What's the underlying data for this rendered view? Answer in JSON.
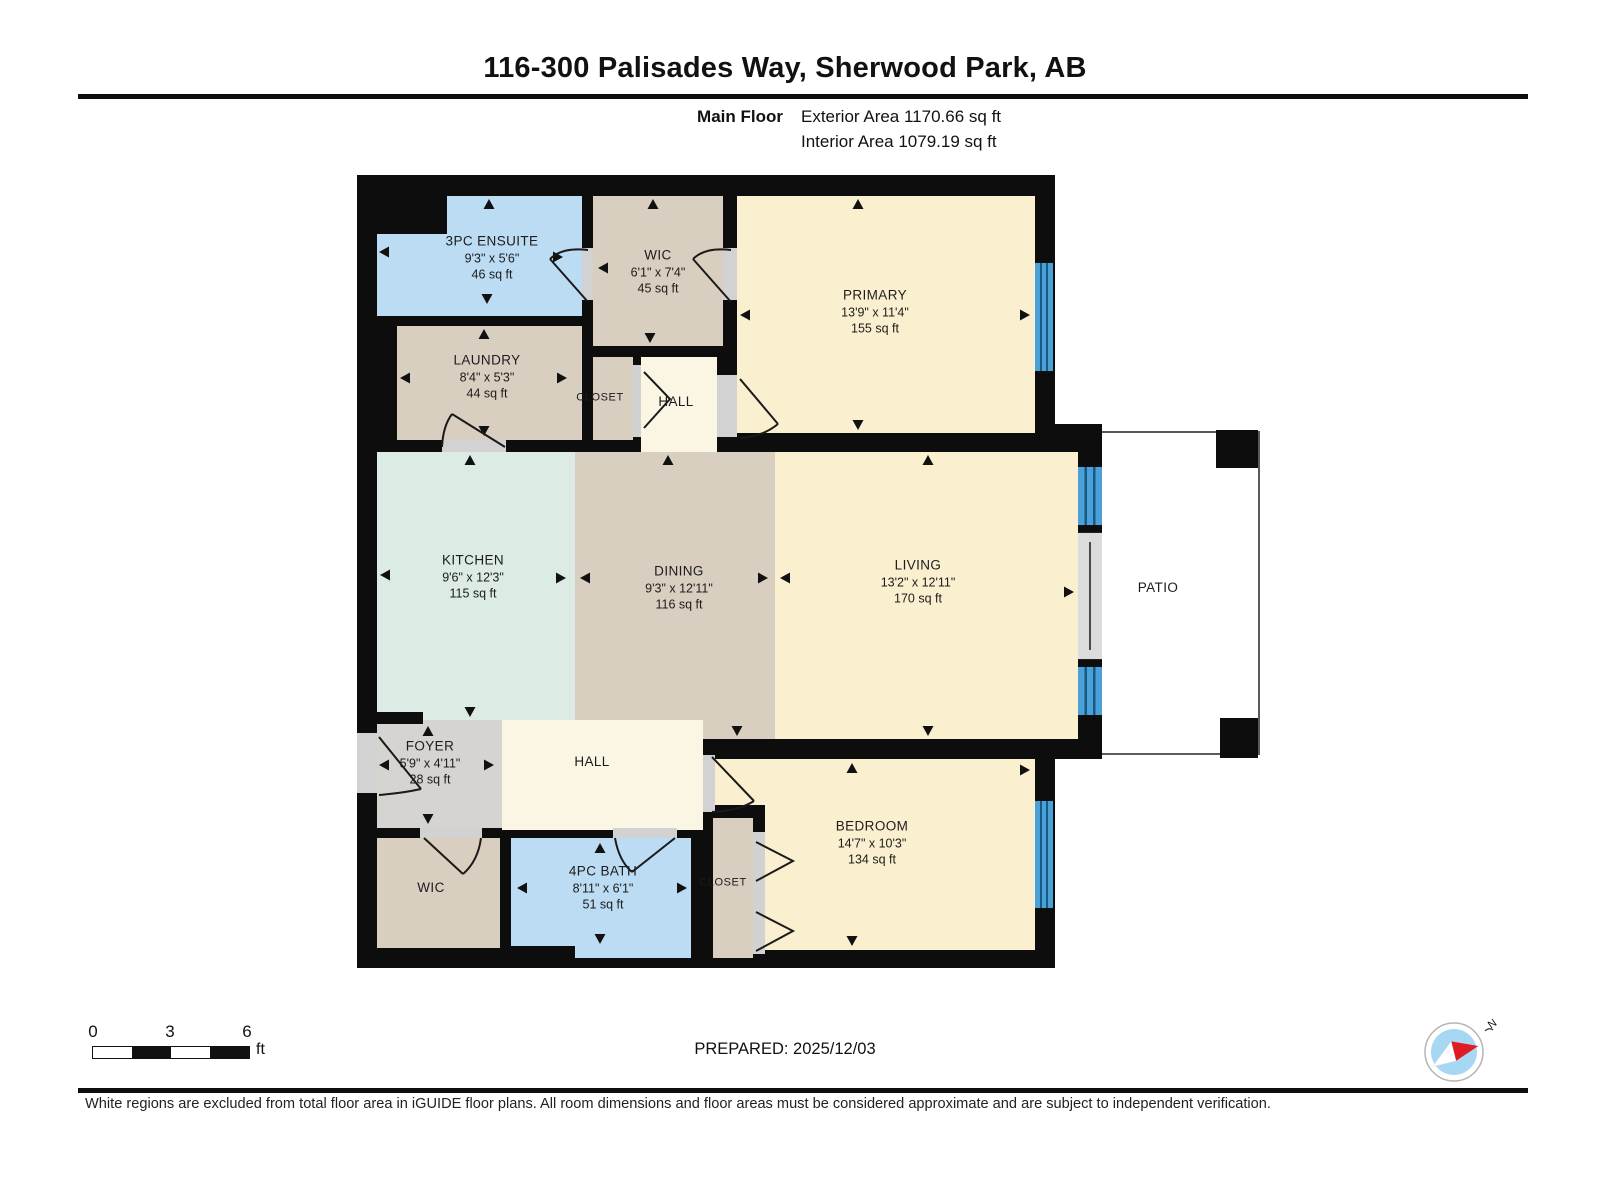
{
  "header": {
    "title": "116-300 Palisades Way, Sherwood Park, AB",
    "floor_label": "Main Floor",
    "exterior_area": "Exterior Area 1170.66 sq ft",
    "interior_area": "Interior Area 1079.19 sq ft"
  },
  "rooms": {
    "ensuite": {
      "name": "3PC ENSUITE",
      "dims": "9'3\" x 5'6\"",
      "area": "46 sq ft"
    },
    "wic_top": {
      "name": "WIC",
      "dims": "6'1\" x 7'4\"",
      "area": "45 sq ft"
    },
    "primary": {
      "name": "PRIMARY",
      "dims": "13'9\" x 11'4\"",
      "area": "155 sq ft"
    },
    "laundry": {
      "name": "LAUNDRY",
      "dims": "8'4\" x 5'3\"",
      "area": "44 sq ft"
    },
    "closet_top": {
      "name": "CLOSET"
    },
    "hall_top": {
      "name": "HALL"
    },
    "kitchen": {
      "name": "KITCHEN",
      "dims": "9'6\" x 12'3\"",
      "area": "115 sq ft"
    },
    "dining": {
      "name": "DINING",
      "dims": "9'3\" x 12'11\"",
      "area": "116 sq ft"
    },
    "living": {
      "name": "LIVING",
      "dims": "13'2\" x 12'11\"",
      "area": "170 sq ft"
    },
    "patio": {
      "name": "PATIO"
    },
    "foyer": {
      "name": "FOYER",
      "dims": "5'9\" x 4'11\"",
      "area": "28 sq ft"
    },
    "hall_bottom": {
      "name": "HALL"
    },
    "wic_bottom": {
      "name": "WIC"
    },
    "bath": {
      "name": "4PC BATH",
      "dims": "8'11\" x 6'1\"",
      "area": "51 sq ft"
    },
    "closet_bottom": {
      "name": "CLOSET"
    },
    "bedroom": {
      "name": "BEDROOM",
      "dims": "14'7\" x 10'3\"",
      "area": "134 sq ft"
    }
  },
  "footer": {
    "prepared": "PREPARED: 2025/12/03",
    "disclaimer": "White regions are excluded from total floor area in iGUIDE floor plans. All room dimensions and floor areas must be considered approximate and are subject to independent verification.",
    "scale": {
      "zero": "0",
      "three": "3",
      "six": "6",
      "unit": "ft"
    },
    "compass_n": "N"
  },
  "colors": {
    "wall": "#0d0d0d",
    "wet_room_blue": "#bcdcf4",
    "tan": "#d9cfc0",
    "cream": "#faf0cf",
    "hall_cream": "#fbf6e4",
    "kitchen_green": "#dcebe3",
    "foyer_gray": "#d6d4d1",
    "window_blue": "#4aa0d7",
    "compass_red": "#e01b24",
    "compass_blue": "#a7d8f3"
  }
}
